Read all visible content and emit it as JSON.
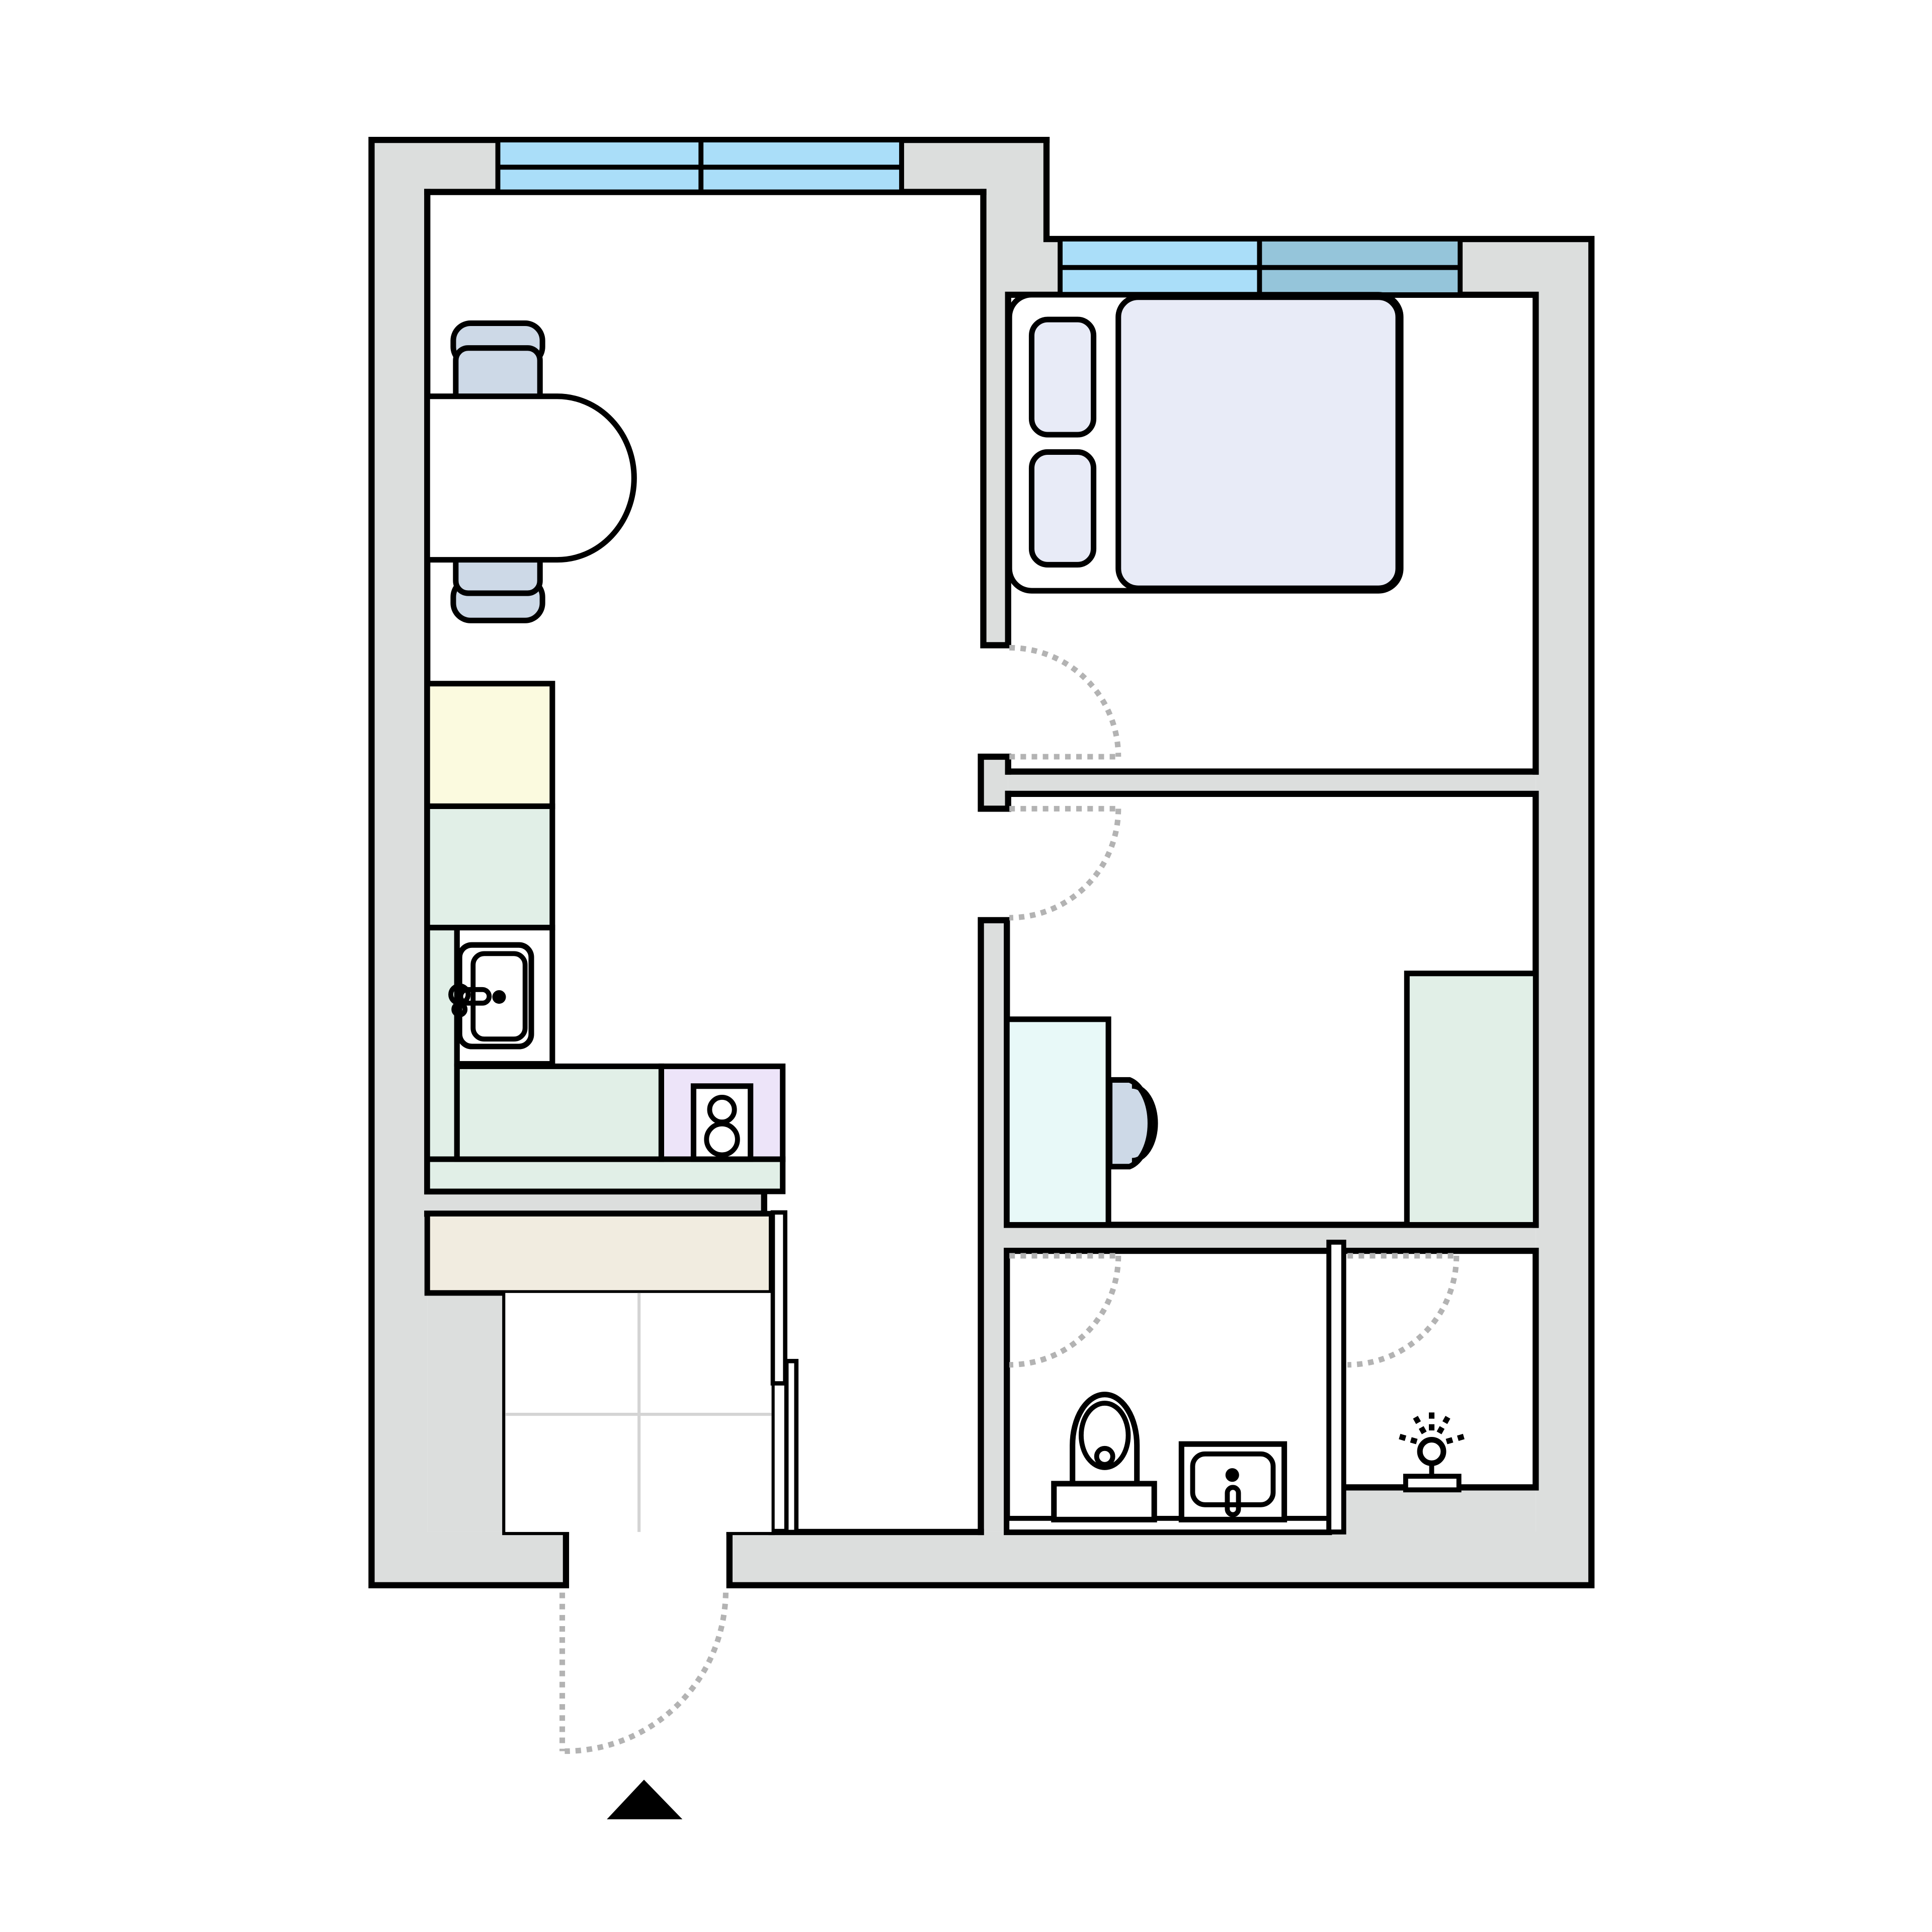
{
  "plan": {
    "type": "apartment-floor-plan",
    "colors": {
      "background": "#ffffff",
      "wall": "#dcdedd",
      "outline": "#000000",
      "window_light": "#aadef9",
      "window_shaded": "#95c5da",
      "bed": "#e8ebf7",
      "pillow": "#e8ebf7",
      "chair": "#cdd9e7",
      "fridge": "#fbfadf",
      "counter": "#e1efe7",
      "stove_zone": "#ede4f9",
      "desk": "#e8f9f8",
      "cabinet": "#e1efe7",
      "wardrobe": "#f1ece0",
      "fixture_white": "#ffffff",
      "tile_line": "#d4d4d4",
      "door_swing": "#b3b3b3",
      "entrance_arrow": "#000000"
    },
    "fixtures": [
      "dining-table",
      "dining-chair-top",
      "dining-chair-bottom",
      "double-bed",
      "pillow-left",
      "pillow-right",
      "fridge",
      "kitchen-counter",
      "kitchen-sink",
      "stove-two-burners",
      "wardrobe",
      "entry-tile-floor",
      "sliding-door-leaves",
      "desk",
      "desk-chair",
      "storage-cabinet",
      "toilet",
      "bathroom-sink",
      "bathroom-shelf",
      "glass-partition",
      "lamp",
      "entrance-arrow",
      "window-living",
      "window-bedroom-light",
      "window-bedroom-shaded",
      "door-swing-bedroom",
      "door-swing-office",
      "door-swing-bathroom",
      "door-swing-lamproom",
      "door-swing-entrance"
    ]
  }
}
